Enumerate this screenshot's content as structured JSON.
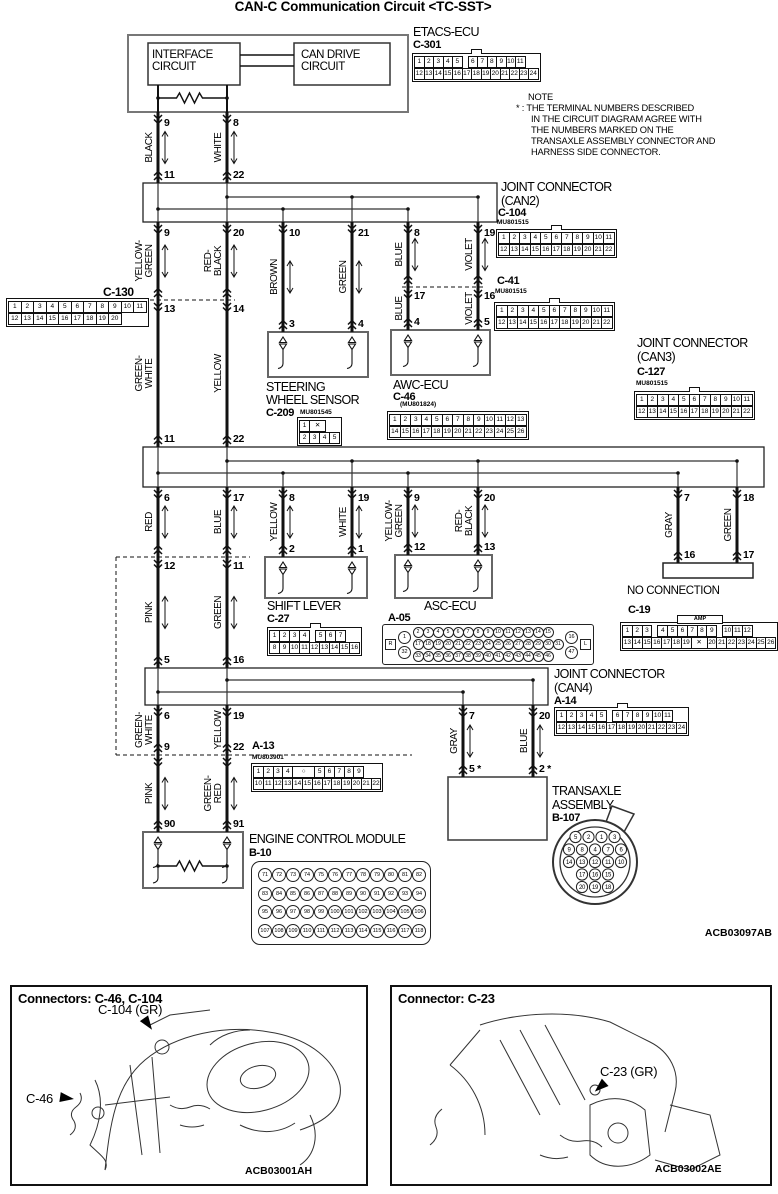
{
  "title": "CAN-C Communication Circuit <TC-SST>",
  "note": {
    "heading": "NOTE",
    "l1": "* : THE TERMINAL NUMBERS DESCRIBED",
    "l2": "IN THE CIRCUIT DIAGRAM AGREE WITH",
    "l3": "THE NUMBERS MARKED ON THE",
    "l4": "TRANSAXLE ASSEMBLY CONNECTOR AND",
    "l5": "HARNESS SIDE CONNECTOR."
  },
  "etacs": {
    "name": "ETACS-ECU",
    "code": "C-301",
    "interface_label": "INTERFACE\nCIRCUIT",
    "can_drive_label": "CAN DRIVE\nCIRCUIT"
  },
  "components": {
    "can2": {
      "line1": "JOINT CONNECTOR",
      "line2": "(CAN2)",
      "code": "C-104",
      "part": "MU801515"
    },
    "c41": {
      "code": "C-41",
      "part": "MU801515"
    },
    "c130": {
      "code": "C-130"
    },
    "steering": {
      "line1": "STEERING",
      "line2": "WHEEL SENSOR",
      "code": "C-209",
      "part": "MU801545"
    },
    "awc": {
      "name": "AWC-ECU",
      "code": "C-46",
      "part": "(MU801824)"
    },
    "can3": {
      "line1": "JOINT CONNECTOR",
      "line2": "(CAN3)",
      "code": "C-127",
      "part": "MU801515"
    },
    "shift": {
      "name": "SHIFT LEVER",
      "code": "C-27"
    },
    "asc": {
      "name": "ASC-ECU",
      "code": "A-05"
    },
    "c19": {
      "code": "C-19",
      "badge": "AMP"
    },
    "no_connection": {
      "label": "NO CONNECTION"
    },
    "can4": {
      "line1": "JOINT CONNECTOR",
      "line2": "(CAN4)",
      "code": "A-14"
    },
    "a13": {
      "code": "A-13",
      "part": "MU803901"
    },
    "transaxle": {
      "line1": "TRANSAXLE",
      "line2": "ASSEMBLY",
      "code": "B-107"
    },
    "ecm": {
      "name": "ENGINE CONTROL MODULE",
      "code": "B-10"
    }
  },
  "diagram_code": "ACB03097AB",
  "wires": [
    {
      "id": "A1",
      "x": 158,
      "y1": 112,
      "y2": 183,
      "top": "9",
      "bottom": "11",
      "bpos": "above",
      "label": "BLACK",
      "arrow": true
    },
    {
      "id": "A2",
      "x": 227,
      "y1": 112,
      "y2": 183,
      "top": "8",
      "bottom": "22",
      "bpos": "above",
      "label": "WHITE",
      "arrow": true
    },
    {
      "id": "B1",
      "x": 158,
      "y1": 222,
      "y2": 300,
      "top": "9",
      "bottom": "13",
      "bpos": "below",
      "label": "YELLOW-\nGREEN",
      "arrow": true
    },
    {
      "id": "B2",
      "x": 227,
      "y1": 222,
      "y2": 300,
      "top": "20",
      "bottom": "14",
      "bpos": "below",
      "label": "RED-\nBLACK",
      "arrow": true
    },
    {
      "id": "B3",
      "x": 283,
      "y1": 222,
      "y2": 332,
      "top": "10",
      "bottom": "3",
      "bpos": "above",
      "label": "BROWN",
      "arrow": true
    },
    {
      "id": "B4",
      "x": 352,
      "y1": 222,
      "y2": 332,
      "top": "21",
      "bottom": "4",
      "bpos": "above",
      "label": "GREEN",
      "arrow": true
    },
    {
      "id": "B5a",
      "x": 408,
      "y1": 222,
      "y2": 287,
      "top": "8",
      "bottom": "17",
      "bpos": "below",
      "label": "BLUE",
      "arrow": true
    },
    {
      "id": "B5b",
      "x": 408,
      "y1": 287,
      "y2": 330,
      "bottom": "4",
      "bpos": "above",
      "label": "BLUE"
    },
    {
      "id": "B6a",
      "x": 478,
      "y1": 222,
      "y2": 287,
      "top": "19",
      "bottom": "16",
      "bpos": "below",
      "label": "VIOLET",
      "arrow": true
    },
    {
      "id": "B6b",
      "x": 478,
      "y1": 287,
      "y2": 330,
      "bottom": "5",
      "bpos": "above",
      "label": "VIOLET"
    },
    {
      "id": "B1b",
      "x": 158,
      "y1": 300,
      "y2": 447,
      "bottom": "11",
      "bpos": "above",
      "label": "GREEN-\nWHITE"
    },
    {
      "id": "B2b",
      "x": 227,
      "y1": 300,
      "y2": 447,
      "bottom": "22",
      "bpos": "above",
      "label": "YELLOW"
    },
    {
      "id": "C1",
      "x": 158,
      "y1": 487,
      "y2": 557,
      "top": "6",
      "bottom": "12",
      "bpos": "below",
      "label": "RED",
      "arrow": true
    },
    {
      "id": "C2",
      "x": 227,
      "y1": 487,
      "y2": 557,
      "top": "17",
      "bottom": "11",
      "bpos": "below",
      "label": "BLUE",
      "arrow": true
    },
    {
      "id": "C3",
      "x": 283,
      "y1": 487,
      "y2": 557,
      "top": "8",
      "bottom": "2",
      "bpos": "above",
      "label": "YELLOW",
      "arrow": true
    },
    {
      "id": "C4",
      "x": 352,
      "y1": 487,
      "y2": 557,
      "top": "19",
      "bottom": "1",
      "bpos": "above",
      "label": "WHITE",
      "arrow": true
    },
    {
      "id": "C5",
      "x": 408,
      "y1": 487,
      "y2": 555,
      "top": "9",
      "bottom": "12",
      "bpos": "above",
      "label": "YELLOW-\nGREEN",
      "arrow": true
    },
    {
      "id": "C6",
      "x": 478,
      "y1": 487,
      "y2": 555,
      "top": "20",
      "bottom": "13",
      "bpos": "above",
      "label": "RED-\nBLACK",
      "arrow": true
    },
    {
      "id": "R1",
      "x": 678,
      "y1": 487,
      "y2": 563,
      "top": "7",
      "bottom": "16",
      "bpos": "above",
      "label": "GRAY"
    },
    {
      "id": "R2",
      "x": 737,
      "y1": 487,
      "y2": 563,
      "top": "18",
      "bottom": "17",
      "bpos": "above",
      "label": "GREEN"
    },
    {
      "id": "D1",
      "x": 158,
      "y1": 557,
      "y2": 668,
      "bottom": "5",
      "bpos": "above",
      "label": "PINK",
      "arrow": true
    },
    {
      "id": "D2",
      "x": 227,
      "y1": 557,
      "y2": 668,
      "bottom": "16",
      "bpos": "above",
      "label": "GREEN",
      "arrow": true
    },
    {
      "id": "E1",
      "x": 158,
      "y1": 705,
      "y2": 755,
      "top": "6",
      "bottom": "9",
      "bpos": "above",
      "label": "GREEN-\nWHITE"
    },
    {
      "id": "E2",
      "x": 227,
      "y1": 705,
      "y2": 755,
      "top": "19",
      "bottom": "22",
      "bpos": "above",
      "label": "YELLOW"
    },
    {
      "id": "E3",
      "x": 463,
      "y1": 705,
      "y2": 777,
      "top": "7",
      "bottom": "5 *",
      "bpos": "above",
      "label": "GRAY",
      "arrow": true
    },
    {
      "id": "E4",
      "x": 533,
      "y1": 705,
      "y2": 777,
      "top": "20",
      "bottom": "2 *",
      "bpos": "above",
      "label": "BLUE",
      "arrow": true
    },
    {
      "id": "F1",
      "x": 158,
      "y1": 755,
      "y2": 832,
      "bottom": "90",
      "bpos": "above",
      "label": "PINK",
      "arrow": true
    },
    {
      "id": "F2",
      "x": 227,
      "y1": 755,
      "y2": 832,
      "bottom": "91",
      "bpos": "above",
      "label": "GREEN-\nRED",
      "arrow": true
    }
  ],
  "connectors": {
    "c301": {
      "tab": true,
      "cell": 8.5,
      "rows": [
        [
          "1",
          "2",
          "3",
          "4",
          "5",
          "",
          "6",
          "7",
          "8",
          "9",
          "10",
          "11"
        ],
        [
          "12",
          "13",
          "14",
          "15",
          "16",
          "17",
          "18",
          "19",
          "20",
          "21",
          "22",
          "23",
          "24"
        ]
      ]
    },
    "c104": {
      "tab": true,
      "cell": 9.5,
      "rows": [
        [
          "1",
          "2",
          "3",
          "4",
          "5",
          "6",
          "7",
          "8",
          "9",
          "10",
          "11"
        ],
        [
          "12",
          "13",
          "14",
          "15",
          "16",
          "17",
          "18",
          "19",
          "20",
          "21",
          "22"
        ]
      ]
    },
    "c41": {
      "tab": true,
      "cell": 9.5,
      "rows": [
        [
          "1",
          "2",
          "3",
          "4",
          "5",
          "6",
          "7",
          "8",
          "9",
          "10",
          "11"
        ],
        [
          "12",
          "13",
          "14",
          "15",
          "16",
          "17",
          "18",
          "19",
          "20",
          "21",
          "22"
        ]
      ]
    },
    "c127": {
      "tab": true,
      "cell": 9.5,
      "rows": [
        [
          "1",
          "2",
          "3",
          "4",
          "5",
          "6",
          "7",
          "8",
          "9",
          "10",
          "11"
        ],
        [
          "12",
          "13",
          "14",
          "15",
          "16",
          "17",
          "18",
          "19",
          "20",
          "21",
          "22"
        ]
      ]
    },
    "c130": {
      "cell": 11.5,
      "rows": [
        [
          "1",
          "2",
          "3",
          "4",
          "5",
          "6",
          "7",
          "8",
          "9",
          "10",
          "11"
        ],
        [
          "12",
          "13",
          "14",
          "15",
          "16",
          "17",
          "18",
          "19",
          "20"
        ]
      ]
    },
    "c209": {
      "cell": 9,
      "rows": [
        [
          "1",
          "✕"
        ],
        [
          "2",
          "3",
          "4",
          "5"
        ]
      ]
    },
    "c46": {
      "cell": 9.5,
      "rows": [
        [
          "1",
          "2",
          "3",
          "4",
          "5",
          "6",
          "7",
          "8",
          "9",
          "10",
          "11",
          "12",
          "13"
        ],
        [
          "14",
          "15",
          "16",
          "17",
          "18",
          "19",
          "20",
          "21",
          "22",
          "23",
          "24",
          "25",
          "26"
        ]
      ]
    },
    "c27": {
      "tab": true,
      "cell": 9,
      "rows": [
        [
          "1",
          "2",
          "3",
          "4",
          "",
          "5",
          "6",
          "7"
        ],
        [
          "8",
          "9",
          "10",
          "11",
          "12",
          "13",
          "14",
          "15",
          "16"
        ]
      ]
    },
    "c19": {
      "badge": "AMP",
      "cell": 8.8,
      "rows": [
        [
          "1",
          "2",
          "3",
          "",
          "4",
          "5",
          "6",
          "7",
          "8",
          "9",
          "",
          "10",
          "11",
          "12"
        ],
        [
          "13",
          "14",
          "15",
          "16",
          "17",
          "18",
          "19",
          "✕",
          "20",
          "21",
          "22",
          "23",
          "24",
          "25",
          "26"
        ]
      ]
    },
    "a14": {
      "tab": true,
      "cell": 9,
      "rows": [
        [
          "1",
          "2",
          "3",
          "4",
          "5",
          "",
          "6",
          "7",
          "8",
          "9",
          "10",
          "11"
        ],
        [
          "12",
          "13",
          "14",
          "15",
          "16",
          "17",
          "18",
          "19",
          "20",
          "21",
          "22",
          "23",
          "24"
        ]
      ]
    },
    "a13": {
      "cell": 8.8,
      "rows": [
        [
          "1",
          "2",
          "3",
          "4",
          "○",
          "5",
          "6",
          "7",
          "8",
          "9"
        ],
        [
          "10",
          "11",
          "12",
          "13",
          "14",
          "15",
          "16",
          "17",
          "18",
          "19",
          "20",
          "21",
          "22"
        ]
      ]
    },
    "a05": {
      "left": "R",
      "right": "L",
      "bigLeft": [
        "1",
        "32"
      ],
      "bigRight": [
        "16",
        "47"
      ],
      "rows": [
        [
          "2",
          "3",
          "4",
          "5",
          "6",
          "7",
          "8",
          "9",
          "10",
          "11",
          "12",
          "13",
          "14",
          "15"
        ],
        [
          "17",
          "18",
          "19",
          "20",
          "21",
          "22",
          "23",
          "24",
          "25",
          "26",
          "27",
          "28",
          "29",
          "30",
          "31"
        ],
        [
          "33",
          "34",
          "35",
          "36",
          "37",
          "38",
          "39",
          "40",
          "41",
          "42",
          "43",
          "44",
          "45",
          "46"
        ]
      ]
    },
    "b10": {
      "rows": [
        [
          "71",
          "72",
          "73",
          "74",
          "75",
          "76",
          "77",
          "78",
          "79",
          "80",
          "81",
          "82"
        ],
        [
          "83",
          "84",
          "85",
          "86",
          "87",
          "88",
          "89",
          "90",
          "91",
          "92",
          "93",
          "94"
        ],
        [
          "95",
          "96",
          "97",
          "98",
          "99",
          "100",
          "101",
          "102",
          "103",
          "104",
          "105",
          "106"
        ],
        [
          "107",
          "108",
          "109",
          "110",
          "111",
          "112",
          "113",
          "114",
          "115",
          "116",
          "117",
          "118"
        ]
      ]
    },
    "b107": {
      "rows": [
        [
          "5",
          "2",
          "1",
          "3"
        ],
        [
          "9",
          "8",
          "4",
          "7",
          "6"
        ],
        [
          "14",
          "13",
          "12",
          "11",
          "10"
        ],
        [
          "17",
          "16",
          "15"
        ],
        [
          "20",
          "19",
          "18"
        ]
      ]
    }
  },
  "panels": {
    "left": {
      "title": "Connectors: C-46, C-104",
      "callout1": "C-104 (GR)",
      "callout2": "C-46",
      "code": "ACB03001AH"
    },
    "right": {
      "title": "Connector: C-23",
      "callout1": "C-23 (GR)",
      "code": "ACB03002AE"
    }
  }
}
